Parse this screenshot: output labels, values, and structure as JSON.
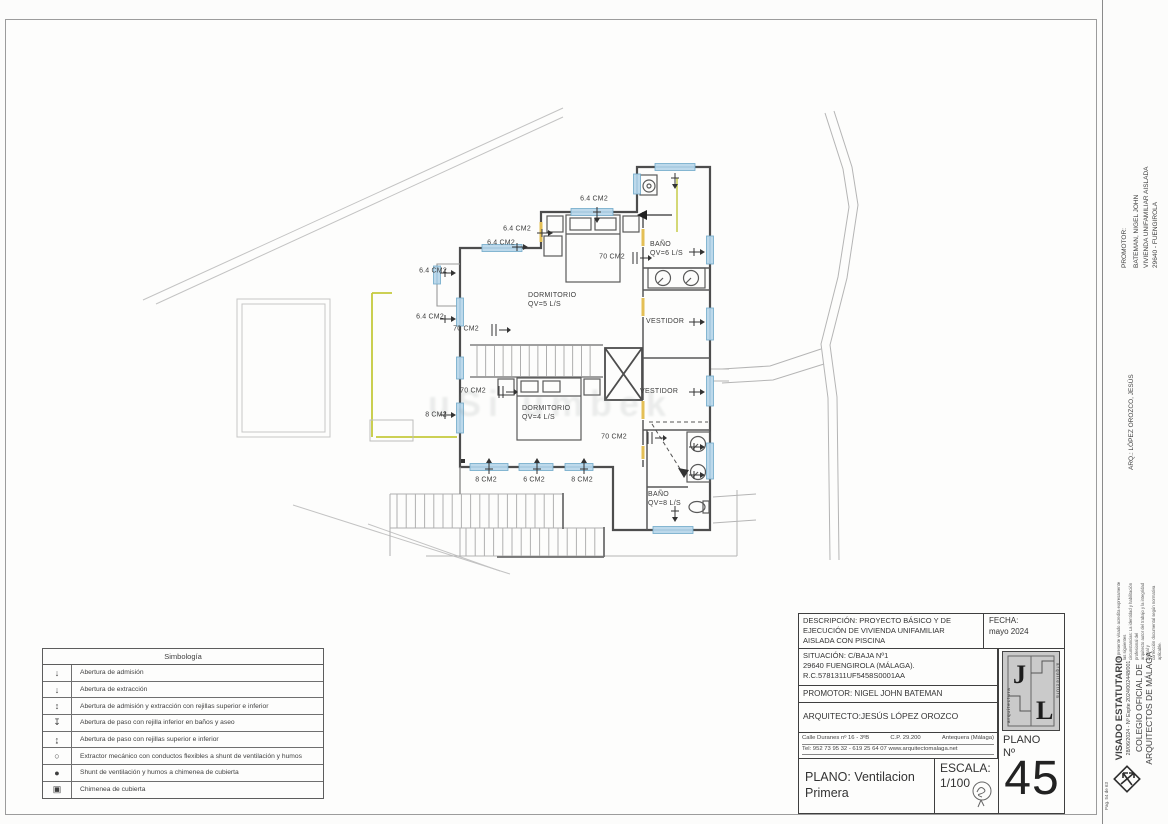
{
  "plan": {
    "watermark": "uSi umbek",
    "size_labels": {
      "s1": "6.4 CM2",
      "s2": "6.4 CM2",
      "s3": "6.4 CM2",
      "s4": "6.4 CM2",
      "s5": "6.4 CM2",
      "p1": "70 CM2",
      "p2": "70 CM2",
      "p3": "70 CM2",
      "p4": "70 CM2",
      "e1": "8 CM2",
      "b1": "8 CM2",
      "b2": "6 CM2",
      "b3": "8 CM2"
    },
    "rooms": {
      "dorm1": [
        "DORMITORIO",
        "QV=5 L/S"
      ],
      "dorm2": [
        "DORMITORIO",
        "QV=4 L/S"
      ],
      "bano1": [
        "BAÑO",
        "QV=6 L/S"
      ],
      "vest1": [
        "VESTIDOR"
      ],
      "vest2": [
        "VESTIDOR"
      ],
      "bano2": [
        "BAÑO",
        "QV=8 L/S"
      ]
    }
  },
  "legend": {
    "title": "Simbología",
    "rows": [
      {
        "symbol": "↓",
        "text": "Abertura de admisión"
      },
      {
        "symbol": "↓",
        "text": "Abertura de extracción"
      },
      {
        "symbol": "↕",
        "text": "Abertura de admisión y extracción con rejillas superior e inferior"
      },
      {
        "symbol": "↧",
        "text": "Abertura de paso con rejilla inferior en baños y aseo"
      },
      {
        "symbol": "↨",
        "text": "Abertura de paso con rejillas superior e inferior"
      },
      {
        "symbol": "○",
        "text": "Extractor mecánico con conductos flexibles a shunt de ventilación y humos"
      },
      {
        "symbol": "●",
        "text": "Shunt de ventilación y humos a chimenea de cubierta"
      },
      {
        "symbol": "▣",
        "text": "Chimenea de cubierta"
      }
    ]
  },
  "title_block": {
    "descripcion": [
      "DESCRIPCIÓN: PROYECTO BÁSICO Y DE",
      "EJECUCIÓN DE VIVIENDA UNIFAMILIAR",
      "AISLADA CON PISCINA"
    ],
    "fecha_label": "FECHA:",
    "fecha_value": "mayo  2024",
    "situacion": [
      "SITUACIÓN:  C/BAJA Nº1",
      "29640 FUENGIROLA (MÁLAGA).",
      "R.C.5781311UF5458S0001AA"
    ],
    "promotor": "PROMOTOR: NIGEL JOHN BATEMAN",
    "arquitecto": "ARQUITECTO:JESÚS LÓPEZ OROZCO",
    "address1a": "Calle Duranes nº 16 - 3ºB",
    "address1b": "C.P. 29.200",
    "address1c": "Antequera (Málaga)",
    "address2": "Tel: 952 73 95 32 - 619 25 64 07 www.arquitectomalaga.net",
    "plano_line1": "PLANO: Ventilacion",
    "plano_line2": "Primera",
    "escala_label": "ESCALA:",
    "escala_value": "1/100",
    "plano_no_label1": "PLANO",
    "plano_no_label2": "Nº",
    "plano_no": "45",
    "logo_j": "J",
    "logo_l": "L",
    "logo_side": "arquitectura"
  },
  "side_column": {
    "promotor_label": "PROMOTOR:",
    "promotor_lines": [
      "BATEMAN, NIGEL JOHN",
      "VIVIENDA UNIFAMILIAR AISLADA",
      "29640 - FUENGIROLA"
    ],
    "arq_line": "ARQ.: LÓPEZ OROZCO, JESÚS",
    "visado_small": [
      "El presente visado acredita expresamente las siguientes",
      "circunstancias: La identidad y habilitación profesional del",
      "arquitecto autor del trabajo y la integridad formal y",
      "corrección documental según normativa aplicable."
    ],
    "visado_title": "VISADO ESTATUTARIO",
    "visado_expte": "28/06/2024 - Nº Expte 2024/002448/001",
    "colegio1": "COLEGIO OFICIAL DE",
    "colegio2": "ARQUITECTOS DE MÁLAGA",
    "page": "Pag. 54 de 63"
  }
}
